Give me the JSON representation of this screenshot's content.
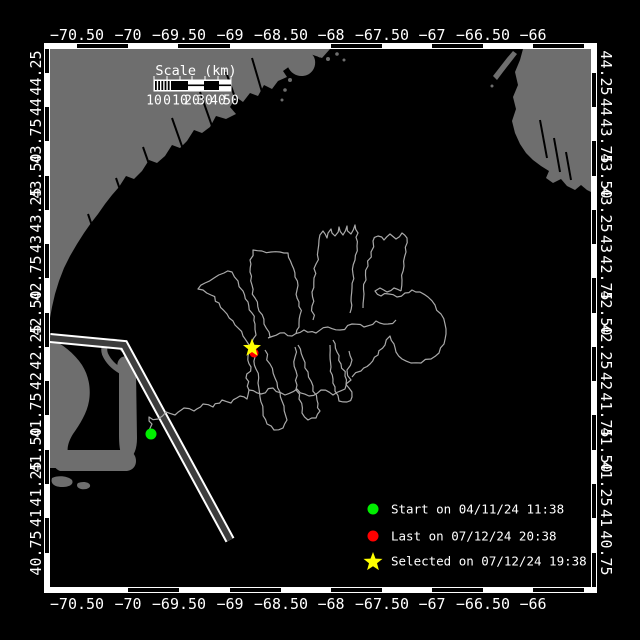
{
  "colors": {
    "ocean": "#000000",
    "land": "#6e6e6e",
    "track": "#aaaaaa",
    "frame": "#ffffff",
    "start": "#00ee00",
    "last": "#ff0000",
    "selected": "#ffff00",
    "lane_median": "#3d3d3d"
  },
  "map_frame": {
    "inner": {
      "x": 50,
      "y": 49,
      "w": 541,
      "h": 538
    },
    "band": 6,
    "bands": {
      "top": {
        "black": [
          [
            77,
            128
          ],
          [
            178,
            230
          ],
          [
            331,
            382
          ],
          [
            432,
            483
          ],
          [
            533,
            584
          ]
        ]
      },
      "bottom": {
        "black": [
          [
            128,
            179
          ],
          [
            230,
            281
          ],
          [
            331,
            382
          ],
          [
            432,
            483
          ],
          [
            533,
            584
          ]
        ]
      },
      "left": {
        "black": [
          [
            49,
            73
          ],
          [
            107,
            141
          ],
          [
            176,
            210
          ],
          [
            244,
            278
          ],
          [
            313,
            347
          ],
          [
            381,
            415
          ],
          [
            450,
            484
          ],
          [
            518,
            553
          ]
        ]
      },
      "right": {
        "black": [
          [
            73,
            107
          ],
          [
            141,
            176
          ],
          [
            210,
            244
          ],
          [
            278,
            313
          ],
          [
            347,
            381
          ],
          [
            415,
            450
          ],
          [
            484,
            518
          ],
          [
            553,
            587
          ]
        ]
      }
    }
  },
  "axes": {
    "top": {
      "y": 35,
      "ticks": [
        {
          "label": "−70.50",
          "x": 77
        },
        {
          "label": "−70",
          "x": 128
        },
        {
          "label": "−69.50",
          "x": 179
        },
        {
          "label": "−69",
          "x": 230
        },
        {
          "label": "−68.50",
          "x": 281
        },
        {
          "label": "−68",
          "x": 331
        },
        {
          "label": "−67.50",
          "x": 382
        },
        {
          "label": "−67",
          "x": 432
        },
        {
          "label": "−66.50",
          "x": 483
        },
        {
          "label": "−66",
          "x": 533
        }
      ]
    },
    "bottom": {
      "y": 604,
      "ticks": [
        {
          "label": "−70.50",
          "x": 77
        },
        {
          "label": "−70",
          "x": 128
        },
        {
          "label": "−69.50",
          "x": 179
        },
        {
          "label": "−69",
          "x": 230
        },
        {
          "label": "−68.50",
          "x": 281
        },
        {
          "label": "−68",
          "x": 331
        },
        {
          "label": "−67.50",
          "x": 382
        },
        {
          "label": "−67",
          "x": 432
        },
        {
          "label": "−66.50",
          "x": 483
        },
        {
          "label": "−66",
          "x": 533
        }
      ]
    },
    "left": {
      "x": 36,
      "ticks": [
        {
          "label": "44.25",
          "y": 73
        },
        {
          "label": "44",
          "y": 107
        },
        {
          "label": "43.75",
          "y": 141
        },
        {
          "label": "43.50",
          "y": 176
        },
        {
          "label": "43.25",
          "y": 210
        },
        {
          "label": "43",
          "y": 244
        },
        {
          "label": "42.75",
          "y": 278
        },
        {
          "label": "42.50",
          "y": 313
        },
        {
          "label": "42.25",
          "y": 347
        },
        {
          "label": "42",
          "y": 381
        },
        {
          "label": "41.75",
          "y": 415
        },
        {
          "label": "41.50",
          "y": 450
        },
        {
          "label": "41.25",
          "y": 484
        },
        {
          "label": "41",
          "y": 518
        },
        {
          "label": "40.75",
          "y": 553
        }
      ]
    },
    "right": {
      "x": 606,
      "ticks": [
        {
          "label": "44.25",
          "y": 73
        },
        {
          "label": "44",
          "y": 107
        },
        {
          "label": "43.75",
          "y": 141
        },
        {
          "label": "43.50",
          "y": 176
        },
        {
          "label": "43.25",
          "y": 210
        },
        {
          "label": "43",
          "y": 244
        },
        {
          "label": "42.75",
          "y": 278
        },
        {
          "label": "42.50",
          "y": 313
        },
        {
          "label": "42.25",
          "y": 347
        },
        {
          "label": "42",
          "y": 381
        },
        {
          "label": "41.75",
          "y": 415
        },
        {
          "label": "41.50",
          "y": 450
        },
        {
          "label": "41.25",
          "y": 484
        },
        {
          "label": "41",
          "y": 518
        },
        {
          "label": "40.75",
          "y": 553
        }
      ]
    }
  },
  "scale_bar": {
    "title": "Scale (km)",
    "title_x": 196,
    "title_y": 71,
    "bar": {
      "x": 154,
      "y": 80,
      "w": 77,
      "h": 11
    },
    "hatch_end": 172,
    "solid_black": [
      [
        172,
        188
      ],
      [
        204,
        219
      ]
    ],
    "midline_white": [
      [
        188,
        204
      ],
      [
        219,
        231
      ]
    ],
    "labels_y": 101,
    "labels": [
      {
        "t": "10",
        "x": 154
      },
      {
        "t": "0",
        "x": 167
      },
      {
        "t": "10",
        "x": 180
      },
      {
        "t": "20",
        "x": 192
      },
      {
        "t": "30",
        "x": 205
      },
      {
        "t": "40",
        "x": 218
      },
      {
        "t": "50",
        "x": 231
      }
    ]
  },
  "legend": {
    "marker_x": 373,
    "text_x": 391,
    "rows": [
      {
        "marker": "circle",
        "color": "#00ee00",
        "y": 509,
        "label": "Start on 04/11/24 11:38"
      },
      {
        "marker": "circle",
        "color": "#ff0000",
        "y": 536,
        "label": "Last on 07/12/24 20:38"
      },
      {
        "marker": "star",
        "color": "#ffff00",
        "y": 561,
        "label": "Selected on 07/12/24 19:38"
      }
    ]
  },
  "markers": {
    "start": {
      "x": 151,
      "y": 434,
      "r": 5.5,
      "color": "#00ee00"
    },
    "last": {
      "x": 254,
      "y": 353,
      "r": 4.5,
      "color": "#ff0000"
    },
    "selected": {
      "x": 252,
      "y": 348,
      "R": 9.5,
      "r": 4,
      "color": "#ffff00"
    }
  },
  "land_paths": [
    "M50,49 L330,49 L322,58 L310,54 L302,62 L295,58 L290,66 L283,71 L287,77 L278,81 L272,89 L264,85 L258,96 L250,93 L243,102 L236,97 L230,107 L236,114 L226,119 L216,116 L210,127 L202,133 L194,130 L187,141 L180,148 L172,145 L165,156 L157,163 L149,160 L142,171 L134,179 L126,176 L119,187 L112,195 L105,204 L98,214 L91,223 L84,233 L77,244 L70,256 L64,268 L59,281 L55,294 L52,307 L50,318 Z",
    "M523,49 L520,60 L515,72 L518,85 L513,97 L516,109 L512,121 L515,133 L520,144 L526,153 L533,160 L541,166 L549,171 L546,178 L553,183 L561,179 L567,186 L575,190 L581,185 L587,190 L591,192 L591,49 Z",
    "M493,76 L500,67 L507,58 L513,51 L517,54 L510,63 L503,72 L497,80 Z",
    "M292,52 C300,48 310,50 314,57 C317,64 314,72 307,75 C299,78 291,74 288,67 C286,61 287,55 292,52 Z",
    "M50,338 C62,344 74,353 82,365 C89,376 91,389 89,401 C87,413 80,424 73,434 C68,442 66,450 69,457 C72,462 78,466 86,468 L50,468 Z",
    "M56,450 L128,450 C134,452 136,457 136,461 C136,466 133,470 127,471 L60,471 C55,469 53,465 53,460 C53,455 54,452 56,450 Z",
    "M119,372 C116,366 117,360 122,357 L130,355 C134,359 135,365 136,372 L137,438 C137,449 134,456 129,459 L122,457 C119,449 119,440 119,432 Z",
    "M52,478 C58,475 68,476 72,480 C74,484 70,487 62,487 C55,487 50,484 52,478 Z",
    "M78,483 C83,481 89,482 90,485 C91,488 86,490 81,489 C77,488 76,485 78,483 Z"
  ],
  "hook_path": "M121,371 C114,367 108,361 105,354 C103,348 105,343 111,342 C116,341 121,344 123,349",
  "islets": [
    [
      320,
      55,
      2.5
    ],
    [
      328,
      59,
      2
    ],
    [
      337,
      54,
      1.8
    ],
    [
      344,
      60,
      1.5
    ],
    [
      290,
      80,
      2
    ],
    [
      285,
      90,
      1.8
    ],
    [
      282,
      100,
      1.5
    ],
    [
      492,
      86,
      1.5
    ]
  ],
  "rivers": [
    [
      252,
      58,
      262,
      92
    ],
    [
      226,
      72,
      238,
      106
    ],
    [
      200,
      92,
      212,
      126
    ],
    [
      172,
      118,
      184,
      152
    ],
    [
      143,
      147,
      155,
      181
    ],
    [
      116,
      178,
      127,
      210
    ],
    [
      88,
      214,
      99,
      246
    ],
    [
      540,
      120,
      547,
      158
    ],
    [
      554,
      138,
      560,
      172
    ],
    [
      566,
      152,
      571,
      180
    ]
  ],
  "shipping_lane": [
    [
      50,
      338
    ],
    [
      124,
      345
    ],
    [
      230,
      540
    ]
  ],
  "track_polylines": [
    [
      [
        151,
        434
      ],
      [
        152,
        424
      ],
      [
        149,
        417
      ],
      [
        158,
        419
      ],
      [
        166,
        412
      ],
      [
        175,
        415
      ],
      [
        184,
        408
      ],
      [
        194,
        411
      ],
      [
        203,
        404
      ],
      [
        213,
        407
      ],
      [
        222,
        400
      ],
      [
        231,
        403
      ],
      [
        240,
        396
      ],
      [
        247,
        399
      ],
      [
        249,
        390
      ]
    ],
    [
      [
        249,
        390
      ],
      [
        246,
        378
      ],
      [
        251,
        367
      ],
      [
        248,
        356
      ],
      [
        252,
        349
      ]
    ],
    [
      [
        249,
        390
      ],
      [
        261,
        394
      ],
      [
        273,
        388
      ],
      [
        285,
        395
      ],
      [
        297,
        389
      ],
      [
        309,
        396
      ],
      [
        321,
        390
      ],
      [
        333,
        395
      ],
      [
        345,
        389
      ],
      [
        351,
        380
      ],
      [
        347,
        370
      ],
      [
        352,
        360
      ],
      [
        349,
        351
      ]
    ],
    [
      [
        251,
        347
      ],
      [
        243,
        336
      ],
      [
        235,
        325
      ],
      [
        227,
        314
      ],
      [
        219,
        303
      ],
      [
        211,
        295
      ],
      [
        203,
        290
      ],
      [
        198,
        289
      ],
      [
        205,
        283
      ],
      [
        214,
        278
      ],
      [
        224,
        273
      ],
      [
        232,
        272
      ],
      [
        238,
        281
      ],
      [
        243,
        291
      ],
      [
        248,
        302
      ],
      [
        252,
        313
      ],
      [
        255,
        324
      ],
      [
        256,
        335
      ],
      [
        252,
        347
      ]
    ],
    [
      [
        270,
        337
      ],
      [
        264,
        324
      ],
      [
        259,
        311
      ],
      [
        255,
        298
      ],
      [
        252,
        285
      ],
      [
        250,
        272
      ],
      [
        250,
        260
      ],
      [
        253,
        250
      ],
      [
        262,
        251
      ],
      [
        271,
        252
      ],
      [
        280,
        252
      ],
      [
        288,
        253
      ],
      [
        292,
        265
      ],
      [
        295,
        277
      ],
      [
        297,
        290
      ],
      [
        299,
        302
      ],
      [
        300,
        315
      ],
      [
        299,
        327
      ],
      [
        296,
        334
      ]
    ],
    [
      [
        313,
        320
      ],
      [
        312,
        306
      ],
      [
        312,
        292
      ],
      [
        314,
        278
      ],
      [
        316,
        264
      ],
      [
        318,
        250
      ],
      [
        319,
        240
      ],
      [
        323,
        231
      ],
      [
        327,
        238
      ],
      [
        331,
        229
      ],
      [
        335,
        236
      ],
      [
        339,
        227
      ],
      [
        343,
        235
      ],
      [
        347,
        226
      ],
      [
        351,
        234
      ],
      [
        355,
        225
      ],
      [
        358,
        233
      ],
      [
        357,
        246
      ],
      [
        355,
        260
      ],
      [
        353,
        274
      ],
      [
        352,
        288
      ],
      [
        351,
        301
      ],
      [
        350,
        313
      ]
    ],
    [
      [
        363,
        308
      ],
      [
        364,
        294
      ],
      [
        366,
        280
      ],
      [
        368,
        266
      ],
      [
        371,
        252
      ],
      [
        373,
        241
      ],
      [
        378,
        236
      ],
      [
        384,
        240
      ],
      [
        390,
        234
      ],
      [
        396,
        239
      ],
      [
        402,
        233
      ],
      [
        407,
        238
      ],
      [
        406,
        252
      ],
      [
        404,
        266
      ],
      [
        402,
        280
      ],
      [
        401,
        291
      ]
    ],
    [
      [
        401,
        291
      ],
      [
        394,
        288
      ],
      [
        387,
        292
      ],
      [
        380,
        288
      ],
      [
        375,
        291
      ],
      [
        381,
        296
      ],
      [
        389,
        294
      ],
      [
        397,
        297
      ],
      [
        405,
        293
      ],
      [
        412,
        290
      ],
      [
        420,
        292
      ],
      [
        428,
        297
      ],
      [
        435,
        305
      ],
      [
        441,
        314
      ],
      [
        445,
        324
      ],
      [
        446,
        334
      ],
      [
        444,
        344
      ],
      [
        439,
        353
      ],
      [
        431,
        359
      ],
      [
        421,
        363
      ],
      [
        411,
        363
      ],
      [
        402,
        359
      ],
      [
        396,
        352
      ],
      [
        394,
        344
      ],
      [
        390,
        336
      ],
      [
        385,
        345
      ],
      [
        378,
        355
      ],
      [
        370,
        364
      ],
      [
        361,
        371
      ],
      [
        352,
        377
      ]
    ],
    [
      [
        268,
        338
      ],
      [
        280,
        333
      ],
      [
        292,
        336
      ],
      [
        304,
        330
      ],
      [
        316,
        333
      ],
      [
        328,
        327
      ],
      [
        340,
        330
      ],
      [
        352,
        324
      ],
      [
        364,
        327
      ],
      [
        376,
        321
      ],
      [
        388,
        324
      ],
      [
        396,
        320
      ]
    ],
    [
      [
        265,
        350
      ],
      [
        270,
        364
      ],
      [
        275,
        378
      ],
      [
        280,
        392
      ],
      [
        284,
        406
      ],
      [
        287,
        420
      ],
      [
        283,
        428
      ],
      [
        274,
        430
      ],
      [
        267,
        424
      ],
      [
        263,
        411
      ],
      [
        260,
        397
      ],
      [
        258,
        383
      ],
      [
        256,
        369
      ],
      [
        255,
        357
      ]
    ],
    [
      [
        298,
        345
      ],
      [
        303,
        358
      ],
      [
        308,
        372
      ],
      [
        313,
        386
      ],
      [
        317,
        400
      ],
      [
        320,
        411
      ],
      [
        316,
        418
      ],
      [
        308,
        420
      ],
      [
        302,
        413
      ],
      [
        299,
        399
      ],
      [
        297,
        385
      ],
      [
        296,
        371
      ],
      [
        295,
        357
      ],
      [
        295,
        347
      ]
    ],
    [
      [
        333,
        340
      ],
      [
        337,
        352
      ],
      [
        341,
        364
      ],
      [
        345,
        376
      ],
      [
        349,
        388
      ],
      [
        352,
        397
      ],
      [
        347,
        402
      ],
      [
        339,
        401
      ],
      [
        335,
        391
      ],
      [
        333,
        379
      ],
      [
        331,
        367
      ],
      [
        330,
        355
      ],
      [
        330,
        345
      ]
    ]
  ]
}
